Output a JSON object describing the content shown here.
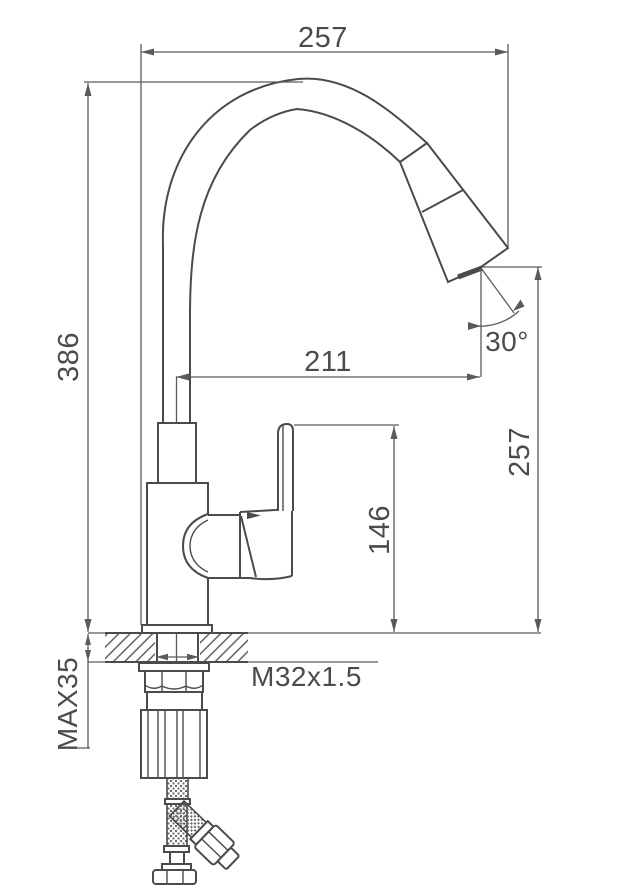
{
  "drawing": {
    "colors": {
      "line": "#4b4b4b",
      "background": "#ffffff"
    },
    "labels": {
      "top_width": "257",
      "overall_height": "386",
      "spout_reach": "211",
      "spray_angle": "30°",
      "outlet_height": "257",
      "body_height": "146",
      "thread": "M32x1.5",
      "max_counter_thickness": "MAX35"
    }
  }
}
